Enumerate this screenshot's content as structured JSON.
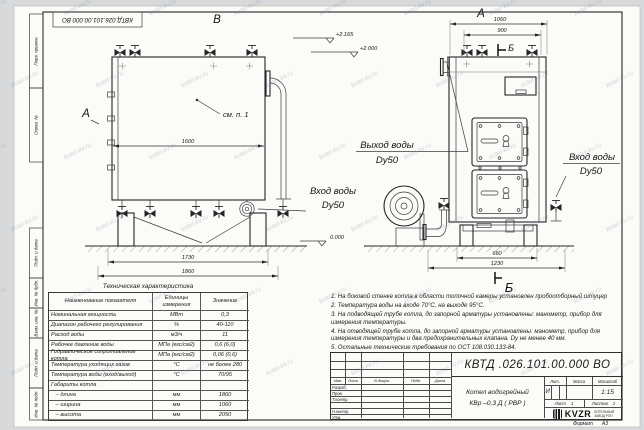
{
  "watermark": {
    "text": "kotel-kv.ru"
  },
  "sheet": {
    "top_doc_number": "КВТД.026.101.00.000  ВО",
    "margin_labels": [
      "Перв. примен.",
      "Справ. №",
      "Подп. и дата",
      "Инв. № дубл.",
      "Взам. инв. №",
      "Подп. и дата",
      "Инв. № подл."
    ],
    "format_label": "Формат",
    "format_value": "А3"
  },
  "drawing": {
    "front_view_label": "В",
    "front_arrow_label": "А",
    "callout_see_item": "см. п. 1",
    "dim_1600": "1600",
    "dim_1730": "1730",
    "dim_1860": "1860",
    "front_inlet_label": "Вход воды",
    "front_inlet_dn": "Dy50",
    "side_view_label": "А",
    "section_label_top": "Б",
    "section_label_bottom": "Б",
    "dim_1060": "1060",
    "dim_900": "900",
    "dim_660": "660",
    "dim_1230": "1230",
    "side_outlet_label": "Выход воды",
    "side_outlet_dn": "Dy50",
    "side_inlet_label": "Вход воды",
    "side_inlet_dn": "Dy50",
    "elev_top": "+2.165",
    "elev_mid": "+2.000",
    "elev_zero": "0.000"
  },
  "notes": [
    "1. На боковой стенке котла в области топочной камеры установлен пробоотборный штуцер",
    "2. Температура воды на входе 70°С, на выходе 95°С.",
    "3. На подводящей трубе котла, до запорной арматуры установлены: манометр, прибор для измерения температуры.",
    "4. На отводящей трубе котла, до запорной арматуры установлены: манометр, прибор для измерения температуры и два предохранительных клапана. Dу не менее 40 мм.",
    "5. Остальные технические требования по ОСТ 108.030.133-84."
  ],
  "tech_table": {
    "title": "Техническая характеристика",
    "headers": [
      "Наименование показателя",
      "Единицы измерения",
      "Значение"
    ],
    "rows": [
      [
        "Номинальная мощность",
        "МВт",
        "0,3"
      ],
      [
        "Диапазон рабочего регулирования",
        "%",
        "40-110"
      ],
      [
        "Расход воды",
        "м3/ч",
        "11"
      ],
      [
        "Рабочее давление воды",
        "МПа (кгс/см2)",
        "0,6 (6,0)"
      ],
      [
        "Гидравлическое сопротивление котла",
        "МПа (кгс/см2)",
        "0,06 (0,6)"
      ],
      [
        "Температура уходящих газов",
        "°С",
        "не более 280"
      ],
      [
        "Температура воды (вход/выход)",
        "°С",
        "70/95"
      ],
      [
        "Габариты котла",
        "",
        ""
      ],
      [
        "   – длина",
        "мм",
        "1860"
      ],
      [
        "   – ширина",
        "мм",
        "1060"
      ],
      [
        "   – высота",
        "мм",
        "2050"
      ]
    ]
  },
  "title_block": {
    "doc_number": "КВТД .026.101.00.000  ВО",
    "product_name_line1": "Котел водогрейный",
    "product_name_line2": "КВр –0,3  Д  ( РВР )",
    "col_izm": "Изм.",
    "col_list": "Лист",
    "col_ndoc": "N докум.",
    "col_podp": "Подп.",
    "col_data": "Дата",
    "row_razrab": "Разраб.",
    "row_prov": "Пров.",
    "row_tkontr": "Т.контр.",
    "row_nkontr": "Н.контр.",
    "row_utv": "Утв.",
    "lit_label": "Лит.",
    "mass_label": "Масса",
    "scale_label": "Масштаб",
    "lit_value": "И",
    "scale_value": "1:15",
    "sheet_label": "Лист",
    "sheet_value": "1",
    "sheets_label": "Листов",
    "sheets_value": "2",
    "logo_text": "KVZR",
    "logo_caption_line1": "КОТЕЛЬНЫЙ",
    "logo_caption_line2": "ЗАВОД РЭП"
  }
}
